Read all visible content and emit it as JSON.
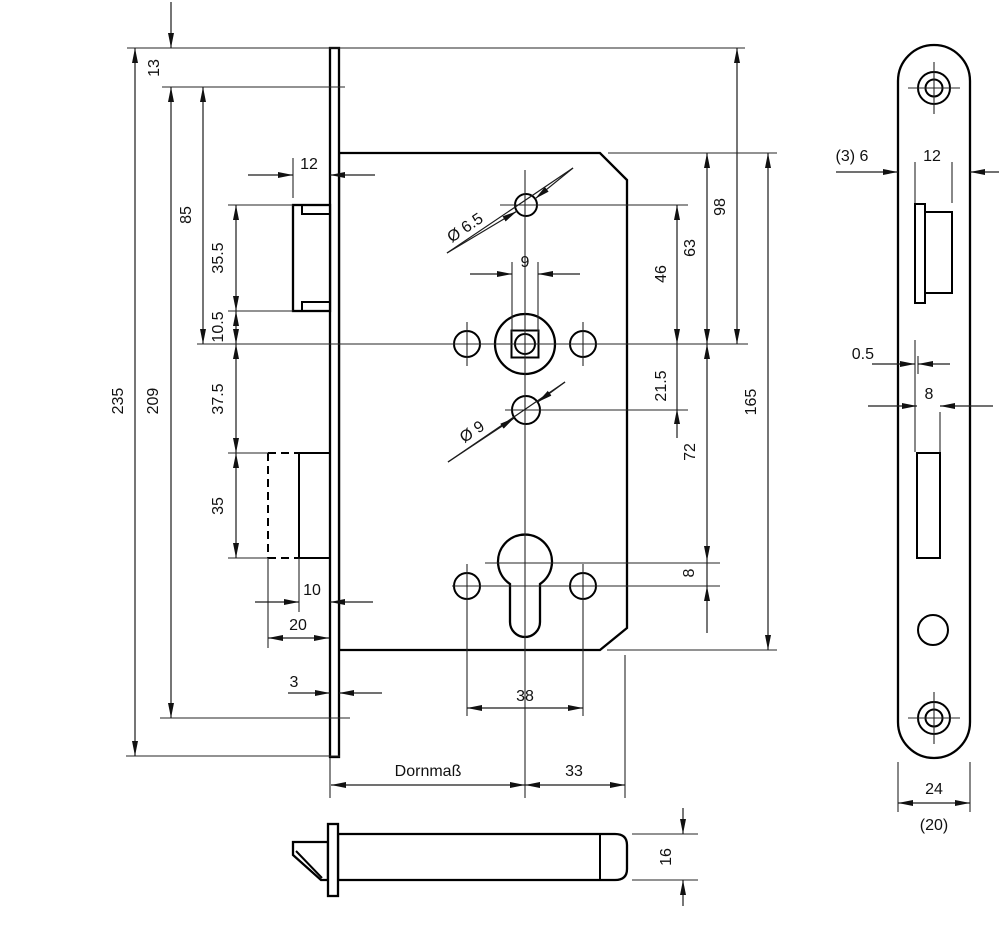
{
  "drawing": {
    "type": "mortise-lock-technical-drawing",
    "line_color": "#000000",
    "background": "#ffffff"
  },
  "main_view": {
    "dims": {
      "top_offset": "13",
      "plate_length": "235",
      "screw_spacing": "209",
      "top_to_follower": "85",
      "latch_height": "35.5",
      "latch_to_follower": "10.5",
      "follower_to_bolt": "37.5",
      "bolt_height": "35",
      "latch_projection": "12",
      "follower_square": "9",
      "top_hole_dia": "Ø 6.5",
      "mid_hole_dia": "Ø 9",
      "plate_top_to_follower": "98",
      "case_top_to_follower": "63",
      "hole_to_follower": "46",
      "follower_to_hole": "21.5",
      "follower_to_cylinder": "72",
      "cylinder_to_holes": "8",
      "case_height": "165",
      "bolt_face": "10",
      "bolt_throw": "20",
      "plate_thickness": "3",
      "hole_spacing": "38",
      "backset": "Dornmaß",
      "cylinder_to_back": "33"
    }
  },
  "front_view": {
    "dims": {
      "edge_note": "(3) 6",
      "latch_width": "12",
      "offset": "0.5",
      "slot_width": "8",
      "plate_width": "24",
      "plate_width_alt": "(20)"
    }
  },
  "bottom_view": {
    "dims": {
      "case_thickness": "16"
    }
  }
}
